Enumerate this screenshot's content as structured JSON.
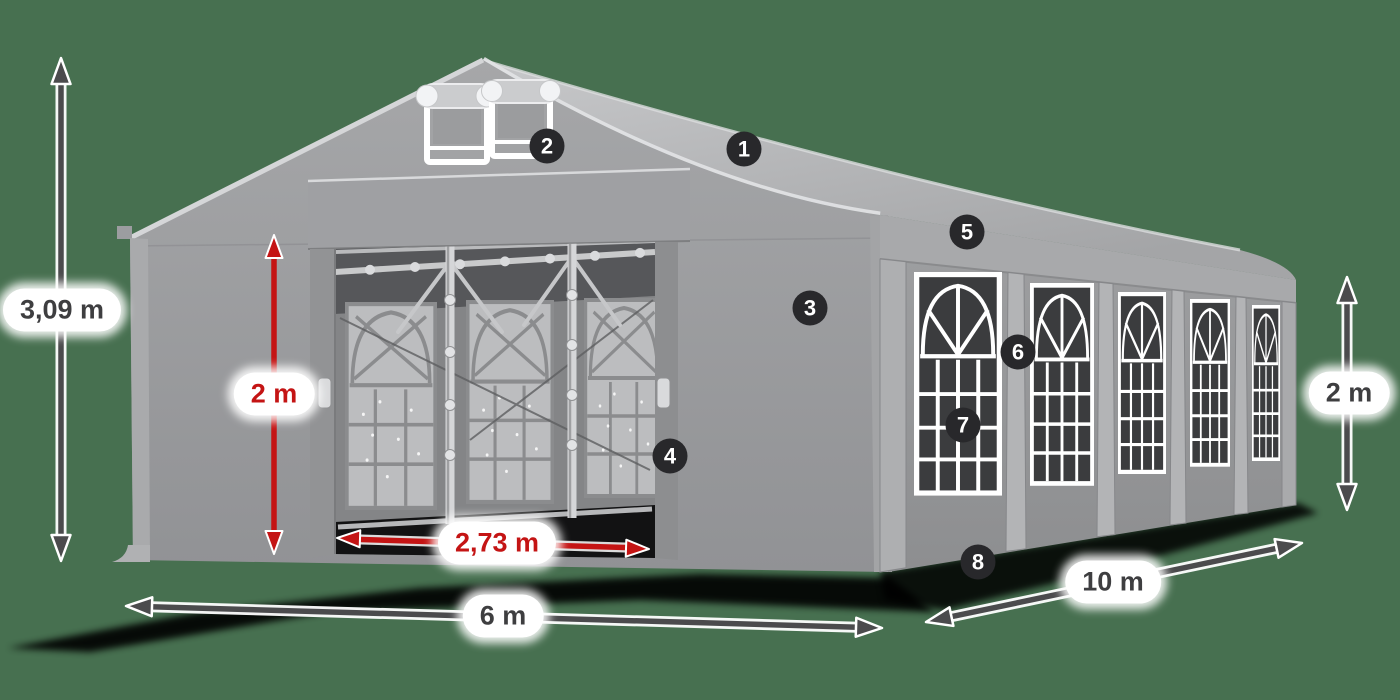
{
  "scene": {
    "description": "Dimension diagram of a grey marquee tent with numbered callouts",
    "colors": {
      "background": "#477050",
      "tent_roof_light": "#c3c4c6",
      "tent_wall_mid": "#9a9b9d",
      "window_mesh_dark": "#3b3c3e",
      "window_frame": "#ffffff",
      "dimension_gray": "#4b4b4d",
      "dimension_red": "#c41414",
      "badge_background": "#28282b",
      "badge_text": "#ffffff",
      "label_background": "#ffffff",
      "label_text": "#3e3e40"
    }
  },
  "dimensions": {
    "total_height": {
      "label": "3,09 m"
    },
    "entrance_height": {
      "label": "2 m"
    },
    "entrance_width": {
      "label": "2,73 m"
    },
    "front_width": {
      "label": "6 m"
    },
    "side_length": {
      "label": "10 m"
    },
    "side_wall_height": {
      "label": "2 m"
    }
  },
  "badges": [
    "1",
    "2",
    "3",
    "4",
    "5",
    "6",
    "7",
    "8"
  ]
}
